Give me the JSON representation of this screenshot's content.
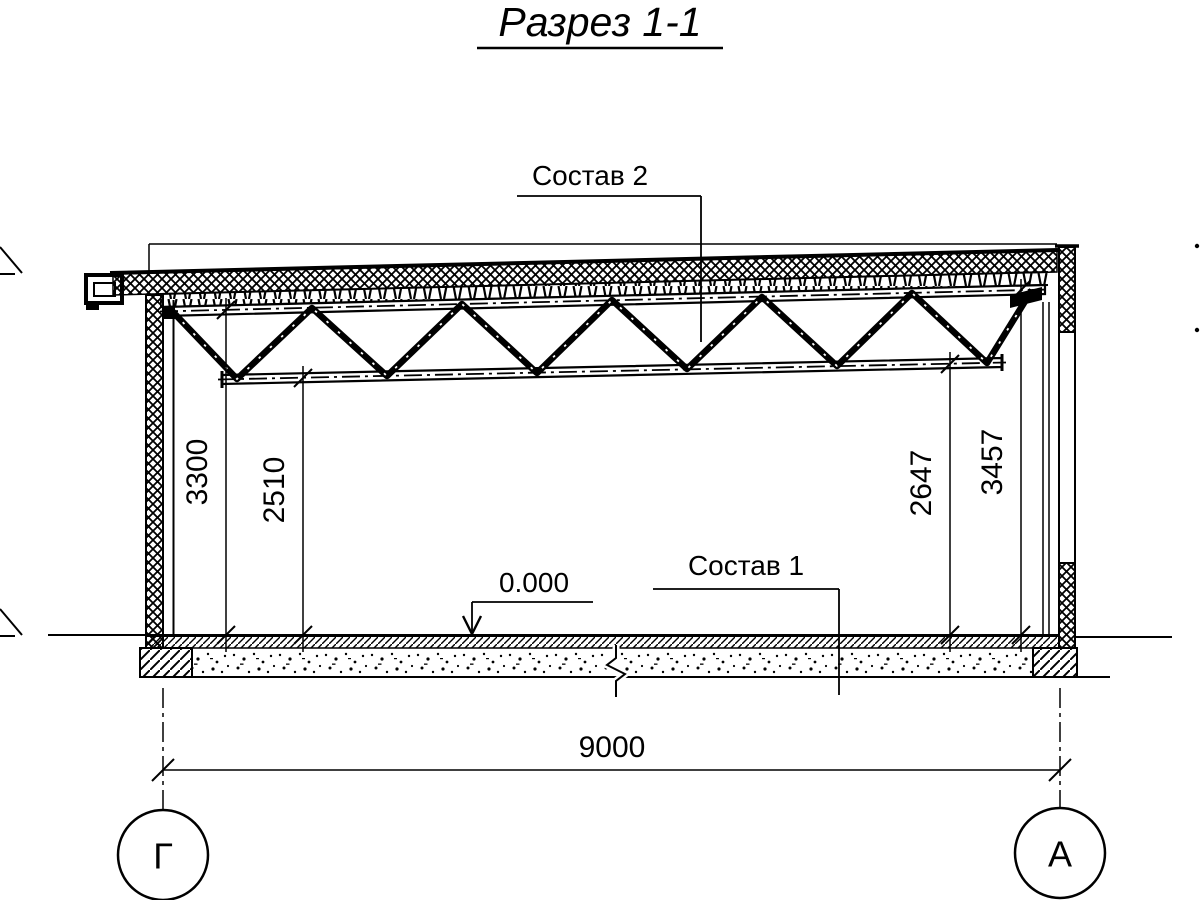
{
  "title": {
    "text": "Разрез 1-1"
  },
  "labels": {
    "roof_composition": "Состав 2",
    "floor_composition": "Состав 1",
    "floor_elevation": "0.000"
  },
  "dimensions": {
    "left_outer": "3300",
    "left_inner": "2510",
    "right_inner": "2647",
    "right_outer": "3457",
    "span": "9000"
  },
  "axes": {
    "left": "Г",
    "right": "А"
  },
  "colors": {
    "ink": "#000000",
    "paper": "#ffffff"
  }
}
